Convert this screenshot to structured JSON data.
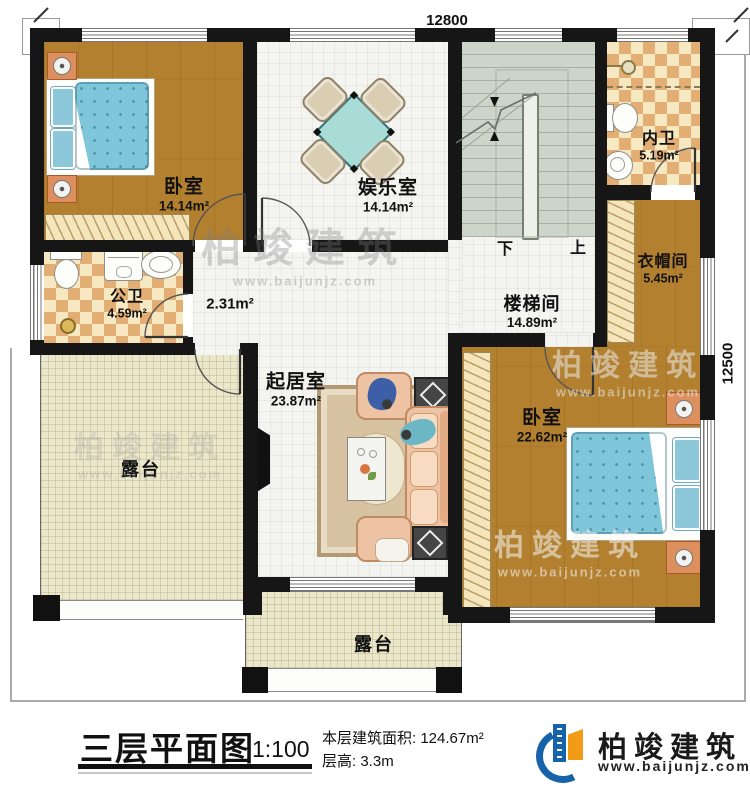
{
  "title": {
    "text": "三层平面图",
    "scale": "1:100"
  },
  "info": {
    "area_label": "本层建筑面积:",
    "area_value": "124.67m²",
    "height_label": "层高:",
    "height_value": "3.3m"
  },
  "brand": {
    "name": "柏竣建筑",
    "website": "www.baijunjz.com"
  },
  "watermark": {
    "line1": "柏竣建筑",
    "line2": "www.baijunjz.com"
  },
  "dimensions": {
    "top": "12800",
    "right": "12500"
  },
  "stairs": {
    "down": "下",
    "up": "上"
  },
  "rooms": [
    {
      "id": "bedroom-1",
      "label": "卧室",
      "area": "14.14m²"
    },
    {
      "id": "entertainment",
      "label": "娱乐室",
      "area": "14.14m²"
    },
    {
      "id": "inner-bath",
      "label": "内卫",
      "area": "5.19m²"
    },
    {
      "id": "cloakroom",
      "label": "衣帽间",
      "area": "5.45m²"
    },
    {
      "id": "public-bath",
      "label": "公卫",
      "area": "4.59m²"
    },
    {
      "id": "hallway",
      "label": "",
      "area": "2.31m²"
    },
    {
      "id": "stairwell",
      "label": "楼梯间",
      "area": "14.89m²"
    },
    {
      "id": "living",
      "label": "起居室",
      "area": "23.87m²"
    },
    {
      "id": "bedroom-2",
      "label": "卧室",
      "area": "22.62m²"
    },
    {
      "id": "terrace-left",
      "label": "露台",
      "area": ""
    },
    {
      "id": "terrace-bottom",
      "label": "露台",
      "area": ""
    }
  ],
  "colors": {
    "wall": "#161616",
    "wood_floor": "#b2802f",
    "checker_light": "#f6e9c2",
    "checker_dark": "#e2ae73",
    "white_tile": "#f4f4f1",
    "terrace": "#ebe7cb",
    "stairs": "#cdd4ca",
    "bed": "#7fc6da",
    "sofa": "#eec3a4",
    "brand_blue": "#1763aa",
    "brand_orange": "#f29b16"
  }
}
